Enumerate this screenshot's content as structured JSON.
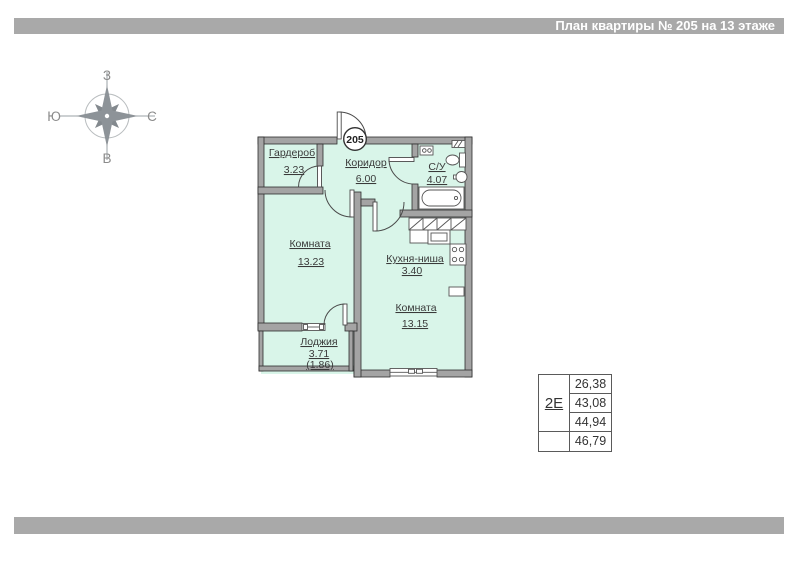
{
  "header": {
    "title": "План квартиры № 205 на 13 этаже"
  },
  "compass": {
    "top": "З",
    "left": "Ю",
    "right": "С",
    "bottom": "В"
  },
  "plan": {
    "entry_badge": "205",
    "rooms": {
      "wardrobe": {
        "name": "Гардероб",
        "area": "3.23"
      },
      "corridor": {
        "name": "Коридор",
        "area": "6.00"
      },
      "bathroom": {
        "name": "С/У",
        "area": "4.07"
      },
      "room1": {
        "name": "Комната",
        "area": "13.23"
      },
      "kitchen": {
        "name": "Кухня-ниша",
        "area": "3.40"
      },
      "room2": {
        "name": "Комната",
        "area": "13.15"
      },
      "loggia": {
        "name": "Лоджия",
        "area": "3.71",
        "area_coeff": "(1.86)"
      }
    },
    "colors": {
      "wall": "#a4a4a4",
      "floor": "#d9f5e9",
      "outline": "#2e2e2e",
      "bar": "#a9a9a9"
    }
  },
  "area_table": {
    "type_label": "2Е",
    "values": [
      "26,38",
      "43,08",
      "44,94",
      "46,79"
    ]
  }
}
